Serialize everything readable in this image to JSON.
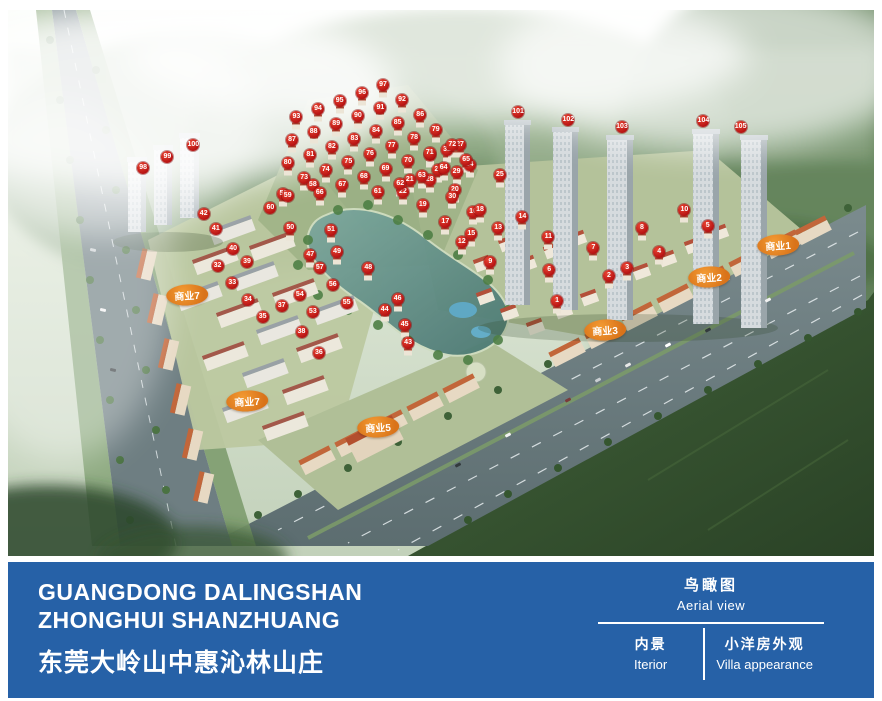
{
  "footer": {
    "bar_color": "#2661a7",
    "title_en_1": "GUANGDONG DALINGSHAN",
    "title_en_2": "ZHONGHUI SHANZHUANG",
    "title_cn": "东莞大岭山中惠沁林山庄",
    "view_cn": "鸟瞰图",
    "view_en": "Aerial view",
    "tab_interior_cn": "内景",
    "tab_interior_en": "Iterior",
    "tab_villa_cn": "小洋房外观",
    "tab_villa_en": "Villa appearance"
  },
  "aerial": {
    "marker_color": "#c01515",
    "label_color": "#e8821e",
    "commercial_labels": [
      {
        "text": "商业1",
        "x": 88.9,
        "y": 43.0
      },
      {
        "text": "商业2",
        "x": 80.9,
        "y": 48.9
      },
      {
        "text": "商业3",
        "x": 68.9,
        "y": 58.6
      },
      {
        "text": "商业5",
        "x": 42.7,
        "y": 76.4
      },
      {
        "text": "商业7",
        "x": 20.7,
        "y": 52.2
      },
      {
        "text": "商业7",
        "x": 27.6,
        "y": 71.6
      }
    ],
    "markers": [
      [
        "1",
        63.4,
        53.3
      ],
      [
        "2",
        69.4,
        48.7
      ],
      [
        "3",
        71.5,
        47.3
      ],
      [
        "4",
        75.2,
        44.3
      ],
      [
        "5",
        80.8,
        39.6
      ],
      [
        "6",
        62.5,
        47.6
      ],
      [
        "7",
        67.6,
        43.6
      ],
      [
        "8",
        73.2,
        39.9
      ],
      [
        "9",
        55.7,
        46.2
      ],
      [
        "10",
        78.1,
        36.6
      ],
      [
        "11",
        62.4,
        41.6
      ],
      [
        "12",
        52.4,
        42.5
      ],
      [
        "13",
        56.6,
        39.9
      ],
      [
        "14",
        59.4,
        37.9
      ],
      [
        "15",
        53.5,
        41.0
      ],
      [
        "16",
        53.7,
        37.0
      ],
      [
        "17",
        50.5,
        38.8
      ],
      [
        "18",
        54.5,
        36.6
      ],
      [
        "19",
        47.9,
        35.7
      ],
      [
        "20",
        51.6,
        33.0
      ],
      [
        "21",
        46.4,
        31.1
      ],
      [
        "22",
        45.6,
        33.3
      ],
      [
        "23",
        49.7,
        29.3
      ],
      [
        "24",
        53.3,
        28.4
      ],
      [
        "25",
        56.8,
        30.2
      ],
      [
        "26",
        48.7,
        26.6
      ],
      [
        "27",
        52.2,
        24.7
      ],
      [
        "28",
        48.7,
        31.1
      ],
      [
        "29",
        51.8,
        29.7
      ],
      [
        "30",
        51.3,
        34.2
      ],
      [
        "31",
        50.7,
        25.6
      ],
      [
        "32",
        24.2,
        46.9
      ],
      [
        "33",
        25.9,
        50.0
      ],
      [
        "34",
        27.7,
        53.1
      ],
      [
        "35",
        29.4,
        56.2
      ],
      [
        "36",
        35.9,
        62.8
      ],
      [
        "37",
        31.6,
        54.2
      ],
      [
        "38",
        33.9,
        59.0
      ],
      [
        "39",
        27.6,
        46.2
      ],
      [
        "40",
        26.0,
        43.8
      ],
      [
        "41",
        24.0,
        40.1
      ],
      [
        "42",
        22.6,
        37.4
      ],
      [
        "43",
        46.2,
        61.0
      ],
      [
        "44",
        43.5,
        54.9
      ],
      [
        "45",
        45.8,
        57.7
      ],
      [
        "46",
        45.0,
        52.9
      ],
      [
        "47",
        34.9,
        44.9
      ],
      [
        "48",
        41.6,
        47.3
      ],
      [
        "49",
        38.0,
        44.3
      ],
      [
        "50",
        32.6,
        39.9
      ],
      [
        "51",
        37.3,
        40.3
      ],
      [
        "52",
        31.8,
        33.7
      ],
      [
        "53",
        35.2,
        55.3
      ],
      [
        "54",
        33.7,
        52.2
      ],
      [
        "55",
        39.1,
        53.7
      ],
      [
        "56",
        37.5,
        50.4
      ],
      [
        "57",
        36.0,
        47.3
      ],
      [
        "58",
        35.2,
        32.1
      ],
      [
        "59",
        32.3,
        34.1
      ],
      [
        "60",
        30.3,
        36.3
      ],
      [
        "61",
        42.7,
        33.3
      ],
      [
        "62",
        45.3,
        31.9
      ],
      [
        "63",
        47.8,
        30.4
      ],
      [
        "64",
        50.3,
        28.9
      ],
      [
        "65",
        52.9,
        27.5
      ],
      [
        "66",
        36.0,
        33.5
      ],
      [
        "67",
        38.6,
        32.1
      ],
      [
        "68",
        41.1,
        30.6
      ],
      [
        "69",
        43.6,
        29.1
      ],
      [
        "70",
        46.2,
        27.7
      ],
      [
        "71",
        48.7,
        26.2
      ],
      [
        "72",
        51.3,
        24.7
      ],
      [
        "73",
        34.2,
        30.8
      ],
      [
        "74",
        36.7,
        29.3
      ],
      [
        "75",
        39.3,
        27.8
      ],
      [
        "76",
        41.8,
        26.4
      ],
      [
        "77",
        44.3,
        24.9
      ],
      [
        "78",
        46.9,
        23.4
      ],
      [
        "79",
        49.4,
        22.0
      ],
      [
        "80",
        32.3,
        28.0
      ],
      [
        "81",
        34.9,
        26.6
      ],
      [
        "82",
        37.4,
        25.1
      ],
      [
        "83",
        40.0,
        23.6
      ],
      [
        "84",
        42.5,
        22.2
      ],
      [
        "85",
        45.0,
        20.7
      ],
      [
        "86",
        47.6,
        19.2
      ],
      [
        "87",
        32.8,
        23.8
      ],
      [
        "88",
        35.3,
        22.3
      ],
      [
        "89",
        37.9,
        20.9
      ],
      [
        "90",
        40.4,
        19.4
      ],
      [
        "91",
        43.0,
        17.9
      ],
      [
        "92",
        45.5,
        16.5
      ],
      [
        "93",
        33.3,
        19.6
      ],
      [
        "94",
        35.8,
        18.1
      ],
      [
        "95",
        38.3,
        16.7
      ],
      [
        "96",
        40.9,
        15.2
      ],
      [
        "97",
        43.3,
        13.7
      ],
      [
        "98",
        15.6,
        28.9
      ],
      [
        "99",
        18.4,
        26.9
      ],
      [
        "100",
        21.4,
        24.7
      ],
      [
        "101",
        58.9,
        18.7
      ],
      [
        "102",
        64.7,
        20.1
      ],
      [
        "103",
        70.9,
        21.4
      ],
      [
        "104",
        80.3,
        20.3
      ],
      [
        "105",
        84.6,
        21.4
      ]
    ]
  }
}
